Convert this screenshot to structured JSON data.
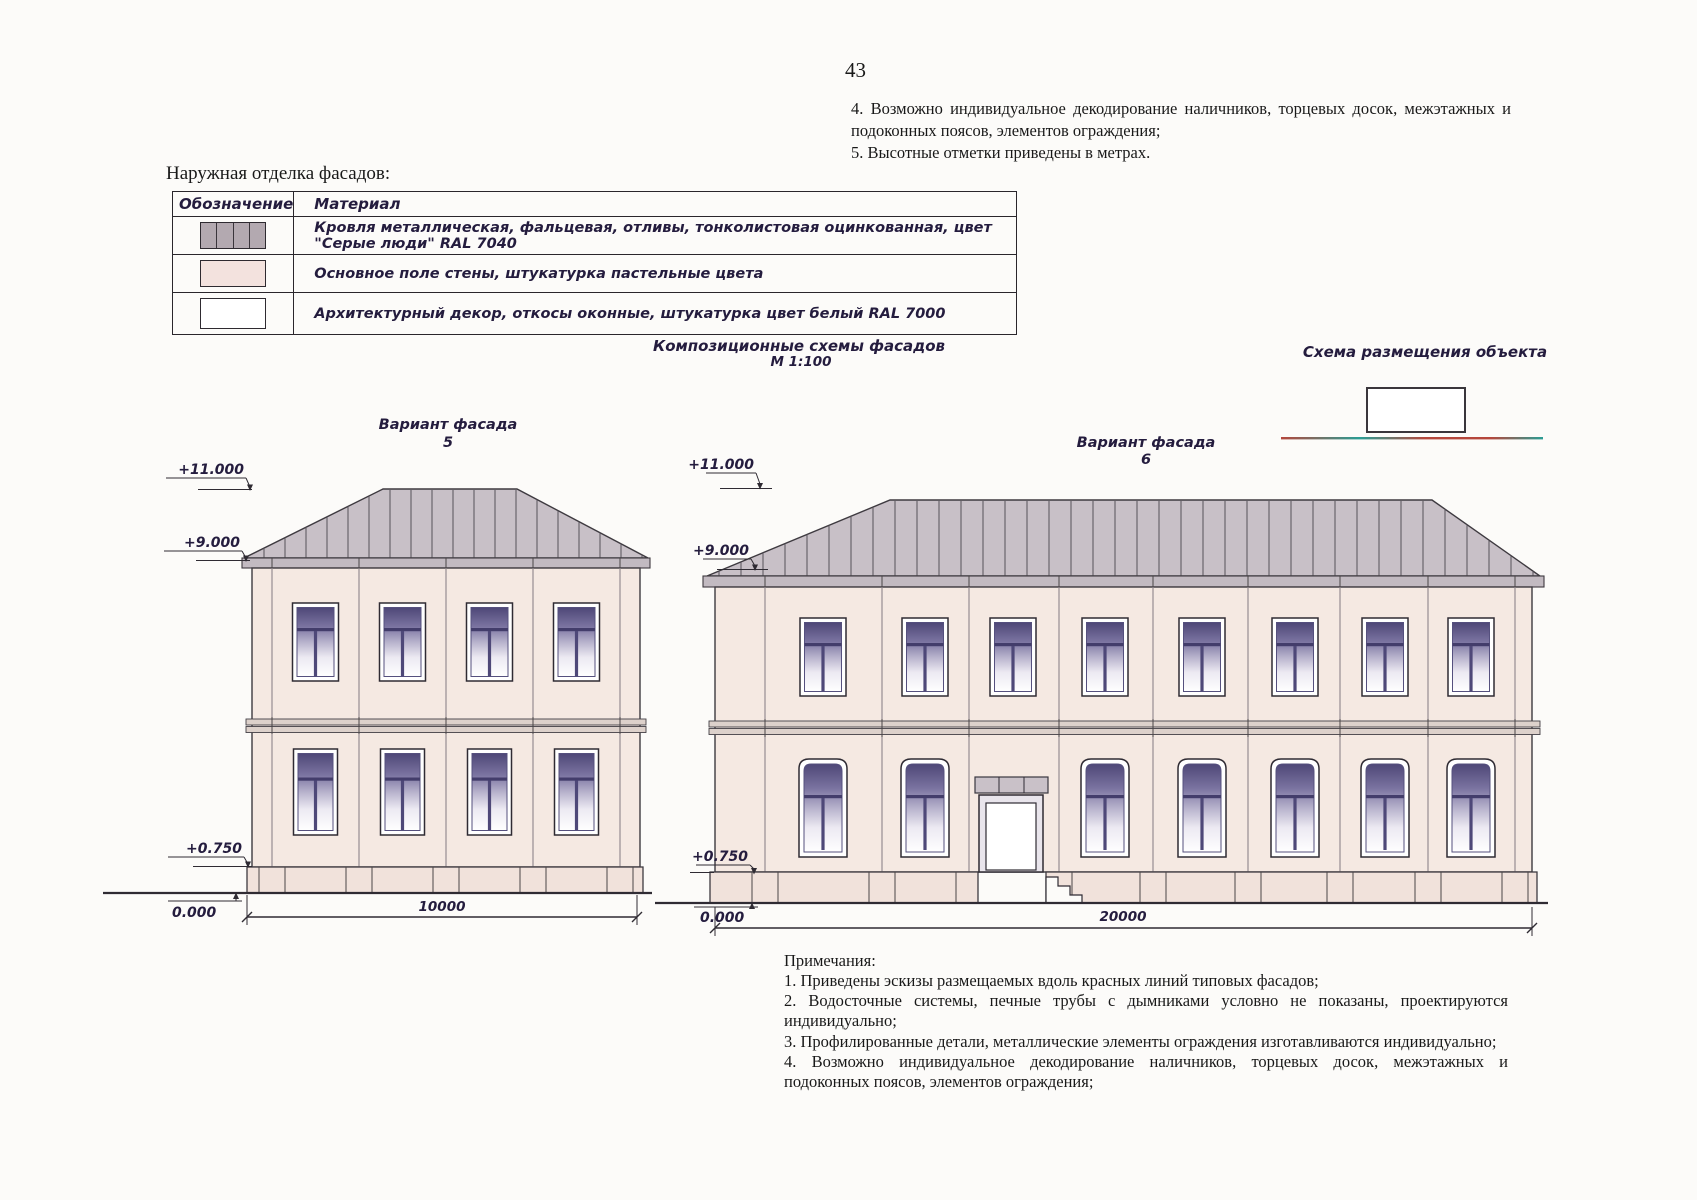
{
  "page": {
    "number": "43"
  },
  "top_notes": {
    "item4": "4. Возможно индивидуальное декодирование наличников, торцевых досок, межэтажных и подоконных поясов, элементов ограждения;",
    "item5": "5. Высотные отметки приведены в метрах."
  },
  "finish_table": {
    "title": "Наружная отделка фасадов:",
    "headers": {
      "designation": "Обозначение",
      "material": "Материал"
    },
    "rows": [
      {
        "swatch": "roof-metal-swatch",
        "material": "Кровля металлическая, фальцевая, отливы, тонколистовая оцинкованная, цвет \"Серые люди\" RAL 7040"
      },
      {
        "swatch": "wall-plaster-swatch",
        "material": "Основное поле стены, штукатурка пастельные цвета"
      },
      {
        "swatch": "white-decor-swatch",
        "material": "Архитектурный декор, откосы оконные, штукатурка цвет белый RAL 7000"
      }
    ]
  },
  "captions": {
    "composition_title": "Композиционные схемы фасадов",
    "composition_scale": "М 1:100",
    "placement_title": "Схема размещения объекта"
  },
  "facade_left": {
    "label": "Вариант фасада",
    "number": "5",
    "marks": {
      "ridge": "+11.000",
      "eaves": "+9.000",
      "plinth": "+0.750",
      "ground": "0.000"
    },
    "dimension": "10000"
  },
  "facade_right": {
    "label": "Вариант фасада",
    "number": "6",
    "marks": {
      "ridge": "+11.000",
      "eaves": "+9.000",
      "plinth": "+0.750",
      "ground": "0.000"
    },
    "dimension": "20000"
  },
  "notes": {
    "title": "Примечания:",
    "items": [
      "1. Приведены эскизы размещаемых вдоль красных линий типовых фасадов;",
      "2. Водосточные системы, печные трубы с дымниками условно не показаны, проектируются индивидуально;",
      "3. Профилированные детали, металлические элементы ограждения изготавливаются индивидуально;",
      "4. Возможно индивидуальное декодирование наличников, торцевых досок, межэтажных и подоконных поясов, элементов ограждения;"
    ]
  },
  "colors": {
    "roof": "#c8c0c7",
    "wall": "#f5e9e2",
    "plinth": "#f1e2db",
    "window_glass_top": "#4e4777",
    "ink_stylized": "#241c3e",
    "red_line": "#b5473c"
  }
}
